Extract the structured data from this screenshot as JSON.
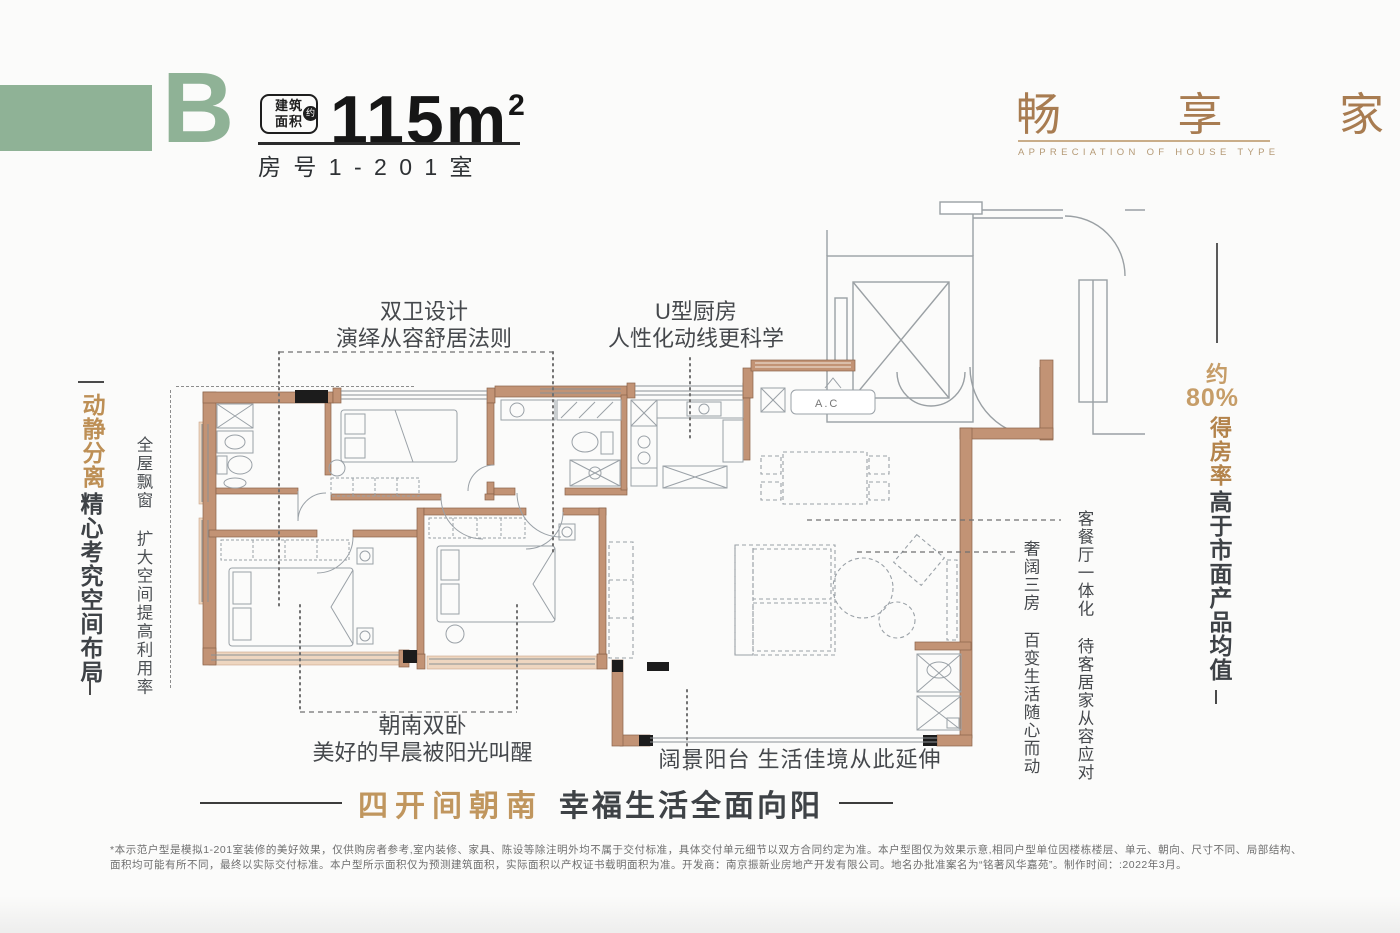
{
  "header": {
    "block_letter": "B",
    "area_badge_line1": "建筑",
    "area_badge_line2": "面积",
    "area_badge_circle": "约",
    "area_value": "115m",
    "area_unit_sup": "2",
    "room_no": "房 号 1 - 2 0 1 室",
    "brand_title": "畅 享 家",
    "brand_subtitle": "APPRECIATION OF HOUSE TYPE"
  },
  "left_panel": {
    "headline_gold": "动静分离",
    "headline_dark": "精心考究空间布局",
    "note": "全屋飘窗 扩大空间提高利用率"
  },
  "right_panel": {
    "approx": "约",
    "percent": "80%",
    "rate": "得房率",
    "headline_dark": "高于市面产品均值"
  },
  "callouts": {
    "bath_line1": "双卫设计",
    "bath_line2": "演绎从容舒居法则",
    "kitchen_line1": "U型厨房",
    "kitchen_line2": "人性化动线更科学",
    "living_vertical": "客餐厅一体化 待客居家从容应对",
    "rooms_vertical": "奢阔三房 百变生活随心而动",
    "bedroom_line1": "朝南双卧",
    "bedroom_line2": "美好的早晨被阳光叫醒",
    "balcony": "阔景阳台  生活佳境从此延伸"
  },
  "floorplan": {
    "ac_label": "A.C"
  },
  "banner": {
    "gold": "四开间朝南",
    "dark": "幸福生活全面向阳"
  },
  "disclaimer": "*本示范户型是模拟1-201室装修的美好效果，仅供购房者参考,室内装修、家具、陈设等除注明外均不属于交付标准，具体交付单元细节以双方合同约定为准。本户型图仅为效果示意,相同户型单位因楼栋楼层、单元、朝向、尺寸不同、局部结构、面积均可能有所不同，最终以实际交付标准。本户型所示面积仅为预测建筑面积，实际面积以产权证书载明面积为准。开发商：南京振新业房地产开发有限公司。地名办批准案名为“铭著风华嘉苑”。制作时间：:2022年3月。",
  "colors": {
    "green": "#8fb296",
    "gold": "#bd8f55",
    "dark_text": "#3e4246",
    "wall": "#c29375",
    "wall_light": "#eed6c0",
    "line_gray": "#9aa1a7"
  }
}
